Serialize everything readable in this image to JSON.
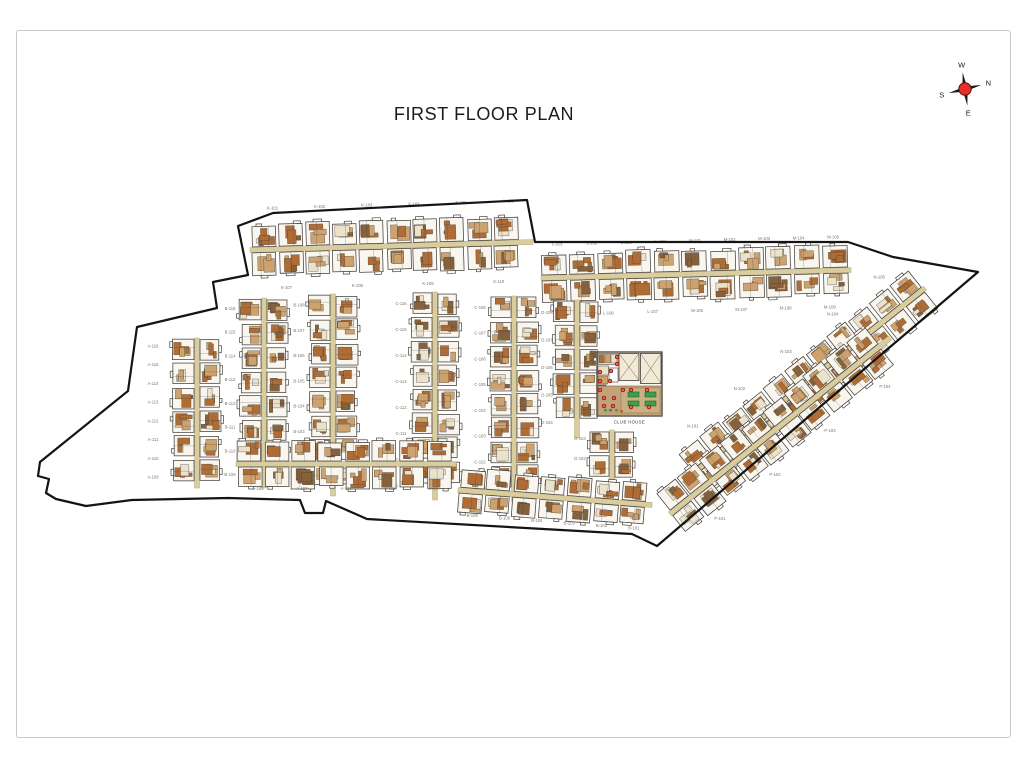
{
  "page": {
    "title": "FIRST FLOOR PLAN"
  },
  "compass": {
    "north": "N",
    "south": "S",
    "east": "E",
    "west": "W"
  },
  "club_house": {
    "label": "CLUB HOUSE",
    "tables": 4,
    "markers": 16
  },
  "palette": {
    "boundary": "#141414",
    "wall": "#454039",
    "unit_fill": "#f9f6ef",
    "corridor": "#d9cd9f",
    "corridor_edge": "#b6aa78",
    "room_tan": "#cda26e",
    "room_rust": "#b06c35",
    "room_cream": "#ebe2cb",
    "room_brown": "#85613c",
    "terrace": "#c2a278",
    "terrace_inner": "#cbae84",
    "table_green": "#3e9e49",
    "marker_red": "#d6281e",
    "speck_blue": "#4a6fb5",
    "label": "#7b7467",
    "title": "#1b1b1b",
    "frame": "#c9c9c9",
    "compass_red": "#e8302a",
    "compass_dark": "#1a1a1a"
  },
  "plan": {
    "boundary": [
      [
        238,
        226
      ],
      [
        273,
        213
      ],
      [
        527,
        200
      ],
      [
        535,
        242
      ],
      [
        848,
        242
      ],
      [
        893,
        257
      ],
      [
        978,
        272
      ],
      [
        657,
        546
      ],
      [
        632,
        534
      ],
      [
        367,
        519
      ],
      [
        326,
        501
      ],
      [
        323,
        513
      ],
      [
        305,
        513
      ],
      [
        300,
        500
      ],
      [
        228,
        498
      ],
      [
        132,
        500
      ],
      [
        86,
        506
      ],
      [
        56,
        499
      ],
      [
        46,
        493
      ],
      [
        49,
        479
      ],
      [
        38,
        476
      ],
      [
        40,
        462
      ],
      [
        128,
        391
      ],
      [
        137,
        327
      ],
      [
        217,
        308
      ],
      [
        213,
        282
      ],
      [
        248,
        275
      ]
    ],
    "strips": [
      {
        "id": "top-row-west",
        "x1": 250,
        "y1": 250,
        "x2": 533,
        "y2": 242,
        "uw": 27,
        "depth": 22,
        "labels": [
          "K-101",
          "K-102",
          "K-103",
          "K-104",
          "K-105",
          "K-106"
        ],
        "label_off": -40,
        "labels2": [
          "K-107",
          "K-108",
          "K-109",
          "K-110"
        ],
        "label_off2": 40
      },
      {
        "id": "top-row-east",
        "x1": 541,
        "y1": 278,
        "x2": 851,
        "y2": 270,
        "uw": 28,
        "depth": 21,
        "labels": [
          "L-101",
          "L-102",
          "L-103",
          "L-104",
          "M-101",
          "M-102",
          "M-103",
          "M-104",
          "M-105"
        ],
        "label_off": -32,
        "labels2": [
          "L-105",
          "L-106",
          "L-107",
          "M-106",
          "M-107",
          "M-108",
          "M-109"
        ],
        "label_off2": 38
      },
      {
        "id": "col-1",
        "x1": 197,
        "y1": 338,
        "x2": 197,
        "y2": 488,
        "uw": 24,
        "depth": 20,
        "labels": [
          "A-116",
          "A-115",
          "A-114",
          "A-113",
          "A-112",
          "A-111",
          "A-110",
          "A-109"
        ],
        "label_off": 44
      },
      {
        "id": "col-2",
        "x1": 264,
        "y1": 298,
        "x2": 264,
        "y2": 488,
        "uw": 24,
        "depth": 20,
        "labels": [
          "B-116",
          "B-115",
          "B-114",
          "B-113",
          "B-112",
          "B-111",
          "B-110",
          "B-109"
        ],
        "label_off": 34
      },
      {
        "id": "col-3",
        "x1": 333,
        "y1": 294,
        "x2": 333,
        "y2": 496,
        "uw": 24,
        "depth": 20,
        "labels": [
          "B-108",
          "B-107",
          "B-106",
          "B-105",
          "B-104",
          "B-103",
          "B-102",
          "B-101"
        ],
        "label_off": 34
      },
      {
        "id": "col-4",
        "x1": 435,
        "y1": 292,
        "x2": 435,
        "y2": 500,
        "uw": 24,
        "depth": 20,
        "labels": [
          "C-116",
          "C-115",
          "C-114",
          "C-113",
          "C-112",
          "C-111",
          "C-110",
          "C-109"
        ],
        "label_off": 34
      },
      {
        "id": "col-5",
        "x1": 514,
        "y1": 296,
        "x2": 514,
        "y2": 502,
        "uw": 24,
        "depth": 20,
        "labels": [
          "C-108",
          "C-107",
          "C-106",
          "C-105",
          "C-104",
          "C-103",
          "C-102",
          "C-101"
        ],
        "label_off": 34
      },
      {
        "id": "col-6",
        "x1": 577,
        "y1": 300,
        "x2": 577,
        "y2": 438,
        "uw": 24,
        "depth": 19,
        "labels": [
          "D-108",
          "D-107",
          "D-106",
          "D-105",
          "D-104"
        ],
        "label_off": 30
      },
      {
        "id": "col-7",
        "x1": 612,
        "y1": 430,
        "x2": 612,
        "y2": 490,
        "uw": 24,
        "depth": 19,
        "labels": [
          "D-103",
          "D-102",
          "D-101"
        ],
        "label_off": 32
      },
      {
        "id": "bottom-row-west",
        "x1": 236,
        "y1": 464,
        "x2": 456,
        "y2": 464,
        "uw": 27,
        "depth": 20,
        "labels": [
          "A-108",
          "A-107",
          "A-106",
          "B-108",
          "B-107"
        ],
        "label_off": 26
      },
      {
        "id": "bottom-row-east",
        "x1": 458,
        "y1": 490,
        "x2": 652,
        "y2": 505,
        "uw": 27,
        "depth": 18,
        "labels": [
          "B-106",
          "B-105",
          "B-104",
          "B-103",
          "B-102",
          "B-101"
        ],
        "label_off": 26
      },
      {
        "id": "diagonal-row-upper",
        "x1": 692,
        "y1": 474,
        "x2": 925,
        "y2": 288,
        "uw": 27,
        "depth": 20,
        "labels": [
          "N-101",
          "N-102",
          "N-103",
          "N-104",
          "N-105"
        ],
        "label_off": -36
      },
      {
        "id": "diagonal-row-lower",
        "x1": 670,
        "y1": 514,
        "x2": 890,
        "y2": 338,
        "uw": 27,
        "depth": 20,
        "labels": [
          "P-101",
          "P-102",
          "P-103",
          "P-104"
        ],
        "label_off": 36
      }
    ]
  }
}
